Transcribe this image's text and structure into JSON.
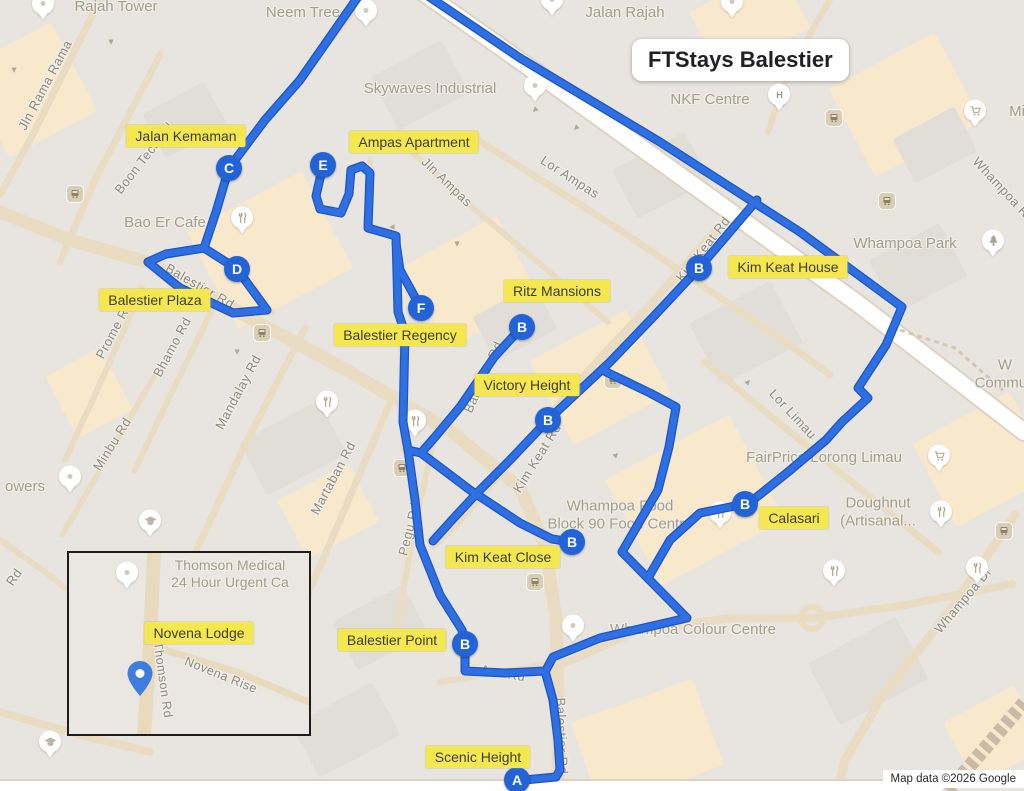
{
  "title": "FTStays Balestier",
  "attribution": "Map data ©2026 Google",
  "colors": {
    "route": "#2e6fe3",
    "route_casing": "#1d55c0",
    "marker_fill": "#2263d8",
    "label_bg": "#f4e74f",
    "map_bg": "#e8e5e0",
    "road_tan": "#eadcc2",
    "road_white": "#ffffff",
    "block_peach": "#f8e8cc",
    "block_gray": "#e1ded7",
    "rail": "#c9bba8"
  },
  "map": {
    "width": 1024,
    "height": 791,
    "routes": [
      {
        "points": "425,-6 520,58 660,142 800,232 902,307 886,345 858,388 868,398 842,422 826,440 788,472 748,504"
      },
      {
        "points": "699,268 757,200"
      },
      {
        "points": "699,268 655,315 610,362 548,420 510,460 478,492 452,520 433,541"
      },
      {
        "points": "602,370 650,393 676,407 669,447 658,490 622,552 687,618 600,638 553,657 545,672"
      },
      {
        "points": "745,504 700,513 670,540 648,578"
      },
      {
        "points": "522,327 495,356 460,407 435,437 421,453"
      },
      {
        "points": "323,165 316,196 320,209 341,213 349,194 351,170 362,166"
      },
      {
        "points": "362,166 370,173 368,228 396,236 398,312 405,333 403,422 408,450 421,453"
      },
      {
        "points": "421,308 400,270 396,243"
      },
      {
        "points": "421,453 470,490 520,523 552,539 572,542"
      },
      {
        "points": "408,450 415,500 420,545 440,595 462,630 465,644 465,671 505,673 545,671"
      },
      {
        "points": "360,-6 300,80 265,120 229,168 216,212 204,248 166,254 148,262"
      },
      {
        "points": "204,248 237,269 267,310 233,313 180,288 148,262"
      },
      {
        "points": "545,671 553,700 558,740 560,770 556,777 524,780"
      }
    ],
    "markers": [
      {
        "letter": "C",
        "x": 229,
        "y": 168
      },
      {
        "letter": "E",
        "x": 323,
        "y": 165
      },
      {
        "letter": "D",
        "x": 237,
        "y": 269
      },
      {
        "letter": "F",
        "x": 421,
        "y": 308
      },
      {
        "letter": "B",
        "x": 522,
        "y": 327
      },
      {
        "letter": "B",
        "x": 699,
        "y": 268
      },
      {
        "letter": "B",
        "x": 548,
        "y": 420
      },
      {
        "letter": "B",
        "x": 745,
        "y": 504
      },
      {
        "letter": "B",
        "x": 572,
        "y": 542
      },
      {
        "letter": "B",
        "x": 465,
        "y": 644
      },
      {
        "letter": "A",
        "x": 517,
        "y": 780
      }
    ],
    "stop_labels": [
      {
        "text": "Jalan Kemaman",
        "x": 186,
        "y": 136
      },
      {
        "text": "Ampas Apartment",
        "x": 414,
        "y": 142
      },
      {
        "text": "Kim Keat House",
        "x": 788,
        "y": 267
      },
      {
        "text": "Balestier Plaza",
        "x": 155,
        "y": 300
      },
      {
        "text": "Ritz Mansions",
        "x": 557,
        "y": 291
      },
      {
        "text": "Balestier Regency",
        "x": 400,
        "y": 335
      },
      {
        "text": "Victory Height",
        "x": 527,
        "y": 385
      },
      {
        "text": "Calasari",
        "x": 794,
        "y": 518
      },
      {
        "text": "Kim Keat Close",
        "x": 503,
        "y": 557
      },
      {
        "text": "Balestier Point",
        "x": 392,
        "y": 640
      },
      {
        "text": "Scenic Height",
        "x": 478,
        "y": 757
      }
    ],
    "street_labels": [
      {
        "text": "Jln Rama Rama",
        "x": 45,
        "y": 85,
        "rot": -62
      },
      {
        "text": "Boon Teck Rd",
        "x": 144,
        "y": 158,
        "rot": -52
      },
      {
        "text": "Balestier Rd",
        "x": 200,
        "y": 286,
        "rot": 30
      },
      {
        "text": "Prome Rd",
        "x": 114,
        "y": 330,
        "rot": -62
      },
      {
        "text": "Bhamo Rd",
        "x": 172,
        "y": 347,
        "rot": -62
      },
      {
        "text": "Mandalay Rd",
        "x": 238,
        "y": 392,
        "rot": -62
      },
      {
        "text": "Minbu Rd",
        "x": 112,
        "y": 444,
        "rot": -58
      },
      {
        "text": "Martaban Rd",
        "x": 333,
        "y": 478,
        "rot": -62
      },
      {
        "text": "Pegu Rd",
        "x": 409,
        "y": 529,
        "rot": -76
      },
      {
        "text": "Jln Ampas",
        "x": 447,
        "y": 182,
        "rot": 44
      },
      {
        "text": "Lor Ampas",
        "x": 570,
        "y": 177,
        "rot": 33
      },
      {
        "text": "Kim Keat Rd",
        "x": 703,
        "y": 249,
        "rot": -52
      },
      {
        "text": "Balestier Rd",
        "x": 483,
        "y": 377,
        "rot": -66
      },
      {
        "text": "Kim Keat Rd",
        "x": 537,
        "y": 458,
        "rot": -58
      },
      {
        "text": "Lor Limau",
        "x": 793,
        "y": 414,
        "rot": 47
      },
      {
        "text": "Whampoa Dr",
        "x": 963,
        "y": 600,
        "rot": -50
      },
      {
        "text": "Whampoa Rd",
        "x": 1004,
        "y": 190,
        "rot": 47
      },
      {
        "text": "Ava Rd",
        "x": 503,
        "y": 673,
        "rot": 10
      },
      {
        "text": "Balestier Rd",
        "x": 562,
        "y": 736,
        "rot": 88
      },
      {
        "text": "Rd",
        "x": 14,
        "y": 577,
        "rot": -55
      }
    ],
    "poi_labels": [
      {
        "lines": [
          "Rajah Tower"
        ],
        "x": 116,
        "y": 7
      },
      {
        "lines": [
          "Neem Tree"
        ],
        "x": 303,
        "y": 13
      },
      {
        "lines": [
          "Jalan Rajah"
        ],
        "x": 625,
        "y": 13
      },
      {
        "lines": [
          "Skywaves Industrial"
        ],
        "x": 430,
        "y": 89
      },
      {
        "lines": [
          "NKF Centre"
        ],
        "x": 710,
        "y": 100
      },
      {
        "lines": [
          "Whampoa Park"
        ],
        "x": 905,
        "y": 244
      },
      {
        "lines": [
          "Bao Er Cafe"
        ],
        "x": 165,
        "y": 223
      },
      {
        "lines": [
          "FairPrice Lorong Limau"
        ],
        "x": 824,
        "y": 458
      },
      {
        "lines": [
          "Whampoa Food",
          "Block 90 Food Centre"
        ],
        "x": 620,
        "y": 516
      },
      {
        "lines": [
          "Doughnut",
          "(Artisanal..."
        ],
        "x": 878,
        "y": 513
      },
      {
        "lines": [
          "Whampoa Colour Centre"
        ],
        "x": 693,
        "y": 630
      },
      {
        "lines": [
          "owers"
        ],
        "x": 25,
        "y": 487
      },
      {
        "lines": [
          "Mi"
        ],
        "x": 1017,
        "y": 112
      },
      {
        "lines": [
          "W",
          "Commun"
        ],
        "x": 1005,
        "y": 375
      }
    ],
    "pins": [
      {
        "type": "generic",
        "x": 43,
        "y": 6
      },
      {
        "type": "generic",
        "x": 366,
        "y": 13
      },
      {
        "type": "generic",
        "x": 552,
        "y": 2
      },
      {
        "type": "generic",
        "x": 732,
        "y": 4
      },
      {
        "type": "generic",
        "x": 535,
        "y": 88
      },
      {
        "type": "generic",
        "x": 70,
        "y": 479
      },
      {
        "type": "generic",
        "x": 573,
        "y": 628
      },
      {
        "type": "restaurant",
        "x": 242,
        "y": 220
      },
      {
        "type": "restaurant",
        "x": 327,
        "y": 404
      },
      {
        "type": "restaurant",
        "x": 415,
        "y": 423
      },
      {
        "type": "restaurant",
        "x": 720,
        "y": 515
      },
      {
        "type": "restaurant",
        "x": 941,
        "y": 514
      },
      {
        "type": "restaurant",
        "x": 834,
        "y": 573
      },
      {
        "type": "restaurant",
        "x": 977,
        "y": 570
      },
      {
        "type": "cart",
        "x": 939,
        "y": 458
      },
      {
        "type": "cart",
        "x": 975,
        "y": 113
      },
      {
        "type": "tree",
        "x": 993,
        "y": 243
      },
      {
        "type": "hospital",
        "x": 779,
        "y": 97
      },
      {
        "type": "grad",
        "x": 150,
        "y": 523
      },
      {
        "type": "grad",
        "x": 50,
        "y": 744
      }
    ],
    "bus_stops": [
      {
        "x": 75,
        "y": 194
      },
      {
        "x": 834,
        "y": 118
      },
      {
        "x": 887,
        "y": 201
      },
      {
        "x": 262,
        "y": 333
      },
      {
        "x": 613,
        "y": 380
      },
      {
        "x": 402,
        "y": 468
      },
      {
        "x": 1004,
        "y": 531
      },
      {
        "x": 535,
        "y": 582
      }
    ],
    "arrows": [
      {
        "x": 14,
        "y": 70,
        "rot": 180
      },
      {
        "x": 392,
        "y": 227,
        "rot": 270
      },
      {
        "x": 576,
        "y": 128,
        "rot": 225
      },
      {
        "x": 237,
        "y": 352,
        "rot": 180
      },
      {
        "x": 126,
        "y": 558,
        "rot": 135
      },
      {
        "x": 748,
        "y": 382,
        "rot": 45
      },
      {
        "x": 457,
        "y": 244,
        "rot": 180
      },
      {
        "x": 616,
        "y": 455,
        "rot": 45
      },
      {
        "x": 535,
        "y": 110,
        "rot": 225
      },
      {
        "x": 111,
        "y": 42,
        "rot": 180
      }
    ],
    "basemap": {
      "white_roads": [
        {
          "points": "420,-10 540,75 700,190 860,305 1024,432",
          "w": 16
        },
        {
          "points": "0,786 940,786",
          "w": 10
        }
      ],
      "rail": {
        "points": "948,791 1024,703",
        "w": 14
      },
      "roundabout": {
        "x": 812,
        "y": 618,
        "r": 11
      },
      "trail": {
        "points": "900,330 955,348 1005,392",
        "w": 3
      },
      "roads": [
        {
          "points": "0,212 70,240 150,263 250,318 350,372 452,432 520,488 545,545 556,620 558,700 558,791",
          "w": 13
        },
        {
          "points": "362,0 265,122 228,170 204,250 163,256 146,263",
          "w": 7
        },
        {
          "points": "146,263 180,290 236,314 272,312",
          "w": 7
        },
        {
          "points": "160,55 95,180 60,262",
          "w": 7
        },
        {
          "points": "100,0 30,140 0,195",
          "w": 7
        },
        {
          "points": "470,135 620,230 790,345 830,375",
          "w": 7
        },
        {
          "points": "718,228 655,300 590,370 520,450 455,525 433,545",
          "w": 9
        },
        {
          "points": "305,328 245,445 192,560",
          "w": 7
        },
        {
          "points": "218,298 168,400 135,470",
          "w": 6
        },
        {
          "points": "142,288 95,395 65,460",
          "w": 6
        },
        {
          "points": "155,375 100,470 62,535",
          "w": 6
        },
        {
          "points": "392,398 340,520 288,640",
          "w": 7
        },
        {
          "points": "432,448 412,540 395,640",
          "w": 6
        },
        {
          "points": "705,362 800,440 880,505 938,552",
          "w": 7
        },
        {
          "points": "1015,515 950,610 880,700 845,760 838,791",
          "w": 9
        },
        {
          "points": "545,672 640,630 730,618 812,618 900,606 1012,584",
          "w": 8
        },
        {
          "points": "440,682 548,664",
          "w": 6
        },
        {
          "points": "830,0 788,72 768,132",
          "w": 6
        },
        {
          "points": "370,160 370,232",
          "w": 5
        },
        {
          "points": "398,236 403,450",
          "w": 5
        },
        {
          "points": "412,152 478,212 545,268 608,322",
          "w": 6
        },
        {
          "points": "0,540 45,572 80,600",
          "w": 6
        },
        {
          "points": "0,712 80,735 150,752",
          "w": 8
        }
      ],
      "blocks": [
        {
          "x": -20,
          "y": 40,
          "w": 100,
          "h": 100,
          "rot": -28,
          "c": "peach"
        },
        {
          "x": 205,
          "y": 195,
          "w": 130,
          "h": 110,
          "rot": -28,
          "c": "peach"
        },
        {
          "x": 420,
          "y": 235,
          "w": 105,
          "h": 95,
          "rot": -28,
          "c": "peach"
        },
        {
          "x": 545,
          "y": 330,
          "w": 110,
          "h": 95,
          "rot": -28,
          "c": "peach"
        },
        {
          "x": 625,
          "y": 440,
          "w": 140,
          "h": 120,
          "rot": -28,
          "c": "peach"
        },
        {
          "x": 845,
          "y": 55,
          "w": 120,
          "h": 100,
          "rot": -28,
          "c": "peach"
        },
        {
          "x": 700,
          "y": -15,
          "w": 100,
          "h": 70,
          "rot": -28,
          "c": "peach"
        },
        {
          "x": 928,
          "y": 412,
          "w": 110,
          "h": 95,
          "rot": -28,
          "c": "peach"
        },
        {
          "x": 582,
          "y": 698,
          "w": 130,
          "h": 92,
          "rot": -20,
          "c": "peach"
        },
        {
          "x": 58,
          "y": 358,
          "w": 62,
          "h": 70,
          "rot": -28,
          "c": "peach"
        },
        {
          "x": 288,
          "y": 478,
          "w": 80,
          "h": 66,
          "rot": -28,
          "c": "peach"
        },
        {
          "x": 955,
          "y": 700,
          "w": 80,
          "h": 70,
          "rot": -28,
          "c": "peach"
        },
        {
          "x": 380,
          "y": 55,
          "w": 80,
          "h": 60,
          "rot": -28,
          "c": "gray"
        },
        {
          "x": 150,
          "y": 95,
          "w": 70,
          "h": 50,
          "rot": -28,
          "c": "gray"
        },
        {
          "x": 620,
          "y": 148,
          "w": 82,
          "h": 55,
          "rot": -28,
          "c": "gray"
        },
        {
          "x": 700,
          "y": 298,
          "w": 92,
          "h": 70,
          "rot": -28,
          "c": "gray"
        },
        {
          "x": 878,
          "y": 238,
          "w": 80,
          "h": 60,
          "rot": -28,
          "c": "gray"
        },
        {
          "x": 248,
          "y": 418,
          "w": 90,
          "h": 60,
          "rot": -28,
          "c": "gray"
        },
        {
          "x": 480,
          "y": 298,
          "w": 70,
          "h": 50,
          "rot": -28,
          "c": "gray"
        },
        {
          "x": 818,
          "y": 636,
          "w": 100,
          "h": 70,
          "rot": -28,
          "c": "gray"
        },
        {
          "x": 300,
          "y": 700,
          "w": 92,
          "h": 60,
          "rot": -28,
          "c": "gray"
        },
        {
          "x": 900,
          "y": 120,
          "w": 70,
          "h": 50,
          "rot": -28,
          "c": "gray"
        },
        {
          "x": 340,
          "y": 600,
          "w": 80,
          "h": 55,
          "rot": -28,
          "c": "gray"
        }
      ]
    }
  },
  "inset": {
    "box": {
      "x": 67,
      "y": 551,
      "w": 240,
      "h": 181
    },
    "stop_label": {
      "text": "Novena Lodge",
      "x": 197,
      "y": 631
    },
    "poi_label": {
      "lines": [
        "Thomson Medical",
        "24 Hour Urgent Ca"
      ],
      "x": 228,
      "y": 572
    },
    "poi_pin": {
      "x": 125,
      "y": 573
    },
    "street_labels": [
      {
        "text": "Novena Rise",
        "x": 219,
        "y": 673,
        "rot": 22
      },
      {
        "text": "Thomson Rd",
        "x": 161,
        "y": 678,
        "rot": 82
      }
    ],
    "blue_pin": {
      "x": 138,
      "y": 681
    },
    "roads": [
      {
        "points": "152,551 148,640 142,732",
        "w": 14
      },
      {
        "points": "163,648 235,670 307,700",
        "w": 7
      }
    ]
  }
}
